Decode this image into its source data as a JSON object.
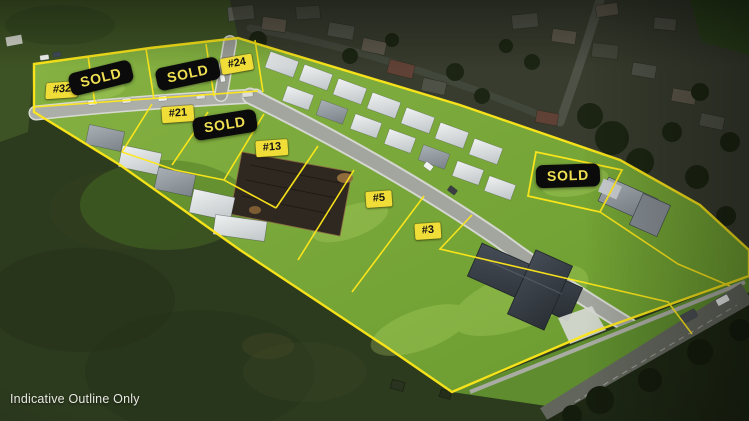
{
  "watermark": {
    "text": "Indicative Outline Only"
  },
  "lots": {
    "lot32": {
      "label": "#32"
    },
    "lot24": {
      "label": "#24"
    },
    "lot21": {
      "label": "#21"
    },
    "lot13": {
      "label": "#13"
    },
    "lot5": {
      "label": "#5"
    },
    "lot3": {
      "label": "#3"
    }
  },
  "sold_badges": {
    "badge1": {
      "label": "SOLD"
    },
    "badge2": {
      "label": "SOLD"
    },
    "badge3": {
      "label": "SOLD"
    },
    "badge4": {
      "label": "SOLD"
    }
  },
  "colors": {
    "boundary_yellow": "#ffe81a",
    "badge_bg": "#0b0b0b",
    "badge_text": "#f0e051",
    "tag_bg": "#f0dd38",
    "tag_text": "#151515",
    "development_grass": "#74a335",
    "outer_field": "#2c3a1e"
  }
}
